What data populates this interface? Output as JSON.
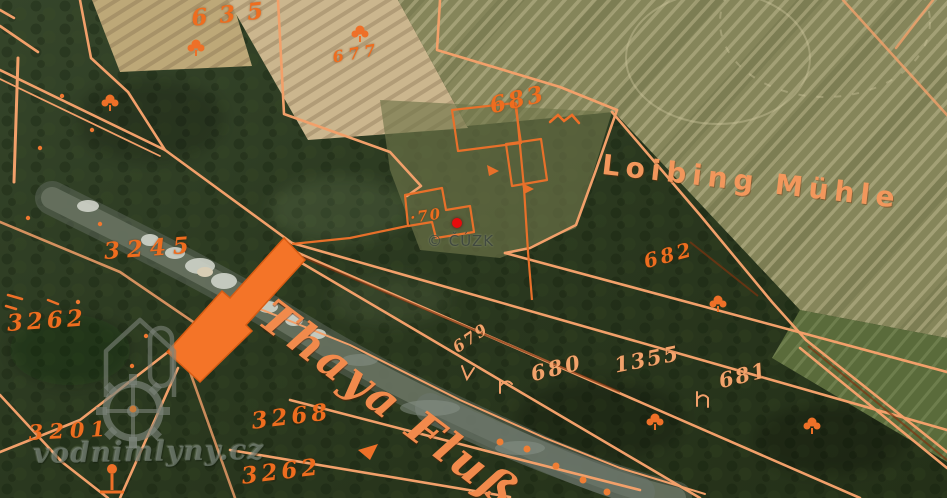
{
  "map": {
    "attribution": "© ČÚZK",
    "watermark_site": "vodnimlyny.cz",
    "place_names": [
      "Loibing Mühle",
      "Thaya Fluß"
    ],
    "parcel_numbers": [
      "635",
      "677",
      "683",
      "70",
      "682",
      "679",
      "680",
      "1355",
      "681",
      "3245",
      "3262",
      "3201",
      "3268",
      "3262"
    ],
    "marker": {
      "x": 452,
      "y": 218,
      "color": "#e60c0c",
      "label": "selected-mill-location"
    },
    "colors": {
      "overlay_line": "#f2a06a",
      "overlay_strong": "#ee6f28",
      "label_orange": "#ee6d1f",
      "field_olive": "#85855a",
      "field_tan": "#cbb68e",
      "forest_green": "#2e3c23",
      "marker_red": "#e60c0c"
    },
    "icons": [
      "waterwheel-icon",
      "mill-house-icon",
      "tree-symbol"
    ]
  },
  "labels": [
    {
      "text": "635",
      "x": 190,
      "y": 5,
      "size": 23,
      "spacing": 12,
      "rot": -6,
      "cls": ""
    },
    {
      "text": "677",
      "x": 331,
      "y": 48,
      "size": 16,
      "spacing": 5,
      "rot": -10,
      "cls": ""
    },
    {
      "text": "683",
      "x": 487,
      "y": 93,
      "size": 23,
      "spacing": 3,
      "rot": -13,
      "cls": ""
    },
    {
      "text": "Loibing Mühle",
      "x": 604,
      "y": 148,
      "size": 28,
      "spacing": 6,
      "rot": 6.5,
      "cls": "title"
    },
    {
      "text": "·70",
      "x": 409,
      "y": 209,
      "size": 15,
      "spacing": 2,
      "rot": -8,
      "cls": ""
    },
    {
      "text": "682",
      "x": 641,
      "y": 250,
      "size": 20,
      "spacing": 3,
      "rot": -15,
      "cls": ""
    },
    {
      "text": "Thaya Fluß",
      "x": 281,
      "y": 289,
      "size": 45,
      "spacing": 3,
      "rot": 37,
      "cls": "river"
    },
    {
      "text": "679",
      "x": 449,
      "y": 341,
      "size": 16,
      "spacing": 2,
      "rot": -34,
      "cls": "pale"
    },
    {
      "text": "680",
      "x": 528,
      "y": 362,
      "size": 21,
      "spacing": 3,
      "rot": -14,
      "cls": "pale"
    },
    {
      "text": "1355",
      "x": 612,
      "y": 353,
      "size": 21,
      "spacing": 2,
      "rot": -11,
      "cls": "pale"
    },
    {
      "text": "681",
      "x": 716,
      "y": 369,
      "size": 21,
      "spacing": 2,
      "rot": -14,
      "cls": "pale"
    },
    {
      "text": "3245",
      "x": 103,
      "y": 238,
      "size": 23,
      "spacing": 7,
      "rot": -4,
      "cls": ""
    },
    {
      "text": "3262",
      "x": 6,
      "y": 310,
      "size": 23,
      "spacing": 4,
      "rot": -4,
      "cls": ""
    },
    {
      "text": "3201",
      "x": 28,
      "y": 420,
      "size": 21,
      "spacing": 6,
      "rot": -3,
      "cls": ""
    },
    {
      "text": "3268",
      "x": 250,
      "y": 408,
      "size": 23,
      "spacing": 4,
      "rot": -7,
      "cls": ""
    },
    {
      "text": "3262",
      "x": 240,
      "y": 463,
      "size": 23,
      "spacing": 4,
      "rot": -7,
      "cls": ""
    },
    {
      "text": "© ČÚZK",
      "x": 427,
      "y": 232,
      "size": 15,
      "spacing": 1,
      "rot": 0,
      "cls": "cuzk"
    },
    {
      "text": "vodnimlyny.cz",
      "x": 33,
      "y": 437,
      "size": 28,
      "spacing": 1,
      "rot": -1,
      "cls": "site"
    }
  ]
}
